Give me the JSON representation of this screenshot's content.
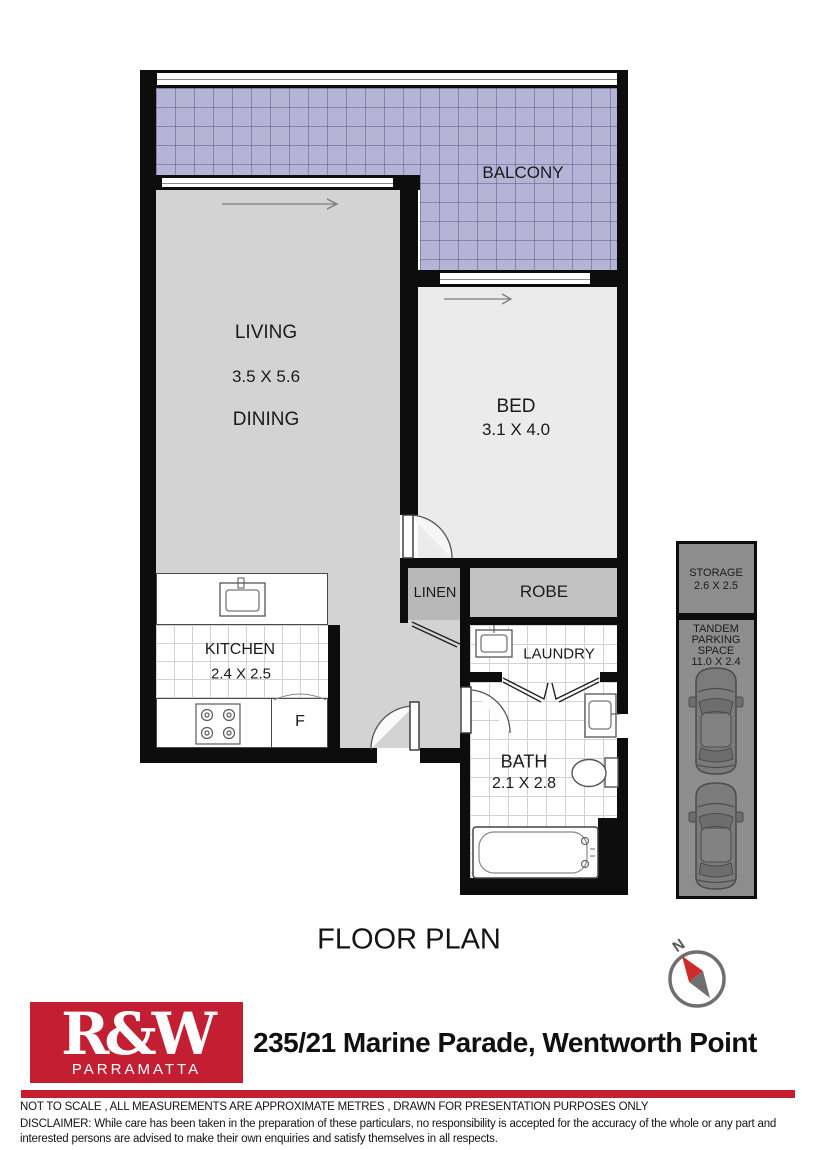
{
  "title": "FLOOR PLAN",
  "compass": {
    "north_label": "N"
  },
  "rooms": {
    "balcony": {
      "name": "BALCONY"
    },
    "living": {
      "name": "LIVING",
      "dims": "3.5 X 5.6"
    },
    "dining": {
      "name": "DINING"
    },
    "bed": {
      "name": "BED",
      "dims": "3.1 X 4.0"
    },
    "robe": {
      "name": "ROBE"
    },
    "linen": {
      "name": "LINEN"
    },
    "kitchen": {
      "name": "KITCHEN",
      "dims": "2.4 X 2.5"
    },
    "fridge": {
      "name": "F"
    },
    "laundry": {
      "name": "LAUNDRY"
    },
    "bath": {
      "name": "BATH",
      "dims": "2.1 X 2.8"
    },
    "storage": {
      "name": "STORAGE",
      "dims": "2.6 X 2.5"
    },
    "parking": {
      "lines": [
        "TANDEM",
        "PARKING",
        "SPACE"
      ],
      "dims": "11.0 X 2.4"
    }
  },
  "footer": {
    "brand": "R&W",
    "brand_office": "PARRAMATTA",
    "address": "235/21 Marine Parade, Wentworth Point",
    "note": "NOT TO SCALE , ALL MEASUREMENTS ARE APPROXIMATE METRES , DRAWN FOR PRESENTATION PURPOSES ONLY",
    "disclaimer": "DISCLAIMER:  While care has been taken in the preparation of these particulars, no responsibility is accepted for the accuracy of the whole or any part and interested persons are advised to make their own enquiries and satisfy  themselves in all respects."
  },
  "colors": {
    "brand_red": "#c41e33",
    "wall_black": "#0d0d0d",
    "balcony_fill": "#b5b3d6",
    "living_fill": "#d3d3d3",
    "bed_fill": "#ebebeb",
    "robe_fill": "#c2c2c2",
    "linen_fill": "#b8b8b8",
    "garage_fill": "#8d8d8d"
  }
}
